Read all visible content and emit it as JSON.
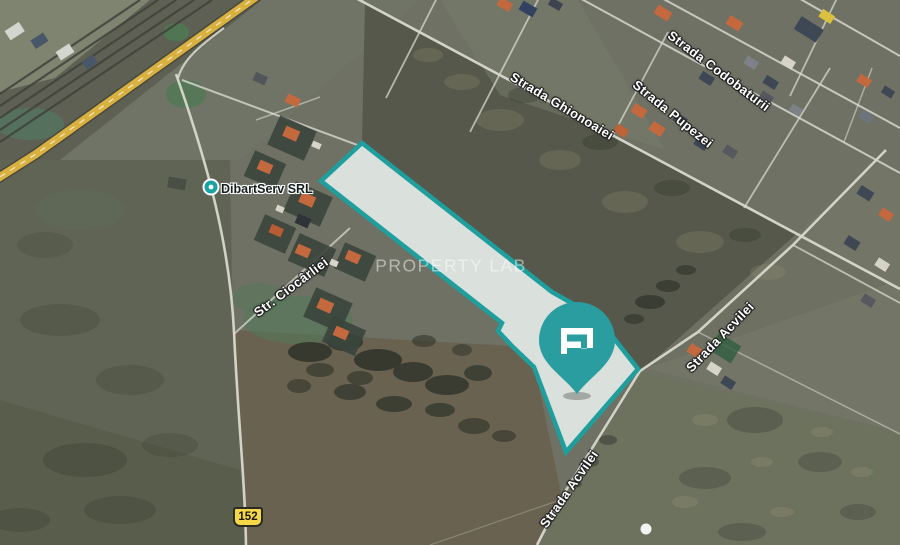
{
  "map": {
    "watermark": "PROPERTY LAB",
    "streets": {
      "ghionoaiei": "Strada Ghionoaiei",
      "codobaturii": "Strada Codobaturii",
      "pupezei": "Strada Pupezei",
      "acvilei_right": "Strada Acvilei",
      "acvilei_bottom": "Strada Acvilei",
      "ciocarliei": "Str. Ciocârliei"
    },
    "poi": {
      "name": "DibartServ SRL"
    },
    "road_badge": "152",
    "parcel": {
      "outline_color": "#1f9e9e",
      "fill_color": "rgba(236,242,240,0.86)"
    },
    "pin": {
      "color": "#2a9da0",
      "logo_icon": "property-lab-p-icon"
    },
    "palette": {
      "highway": "#d9b13f",
      "road": "#d8d8ce",
      "badge_bg": "#f6d748",
      "accent_teal": "#1f9e9e"
    }
  }
}
